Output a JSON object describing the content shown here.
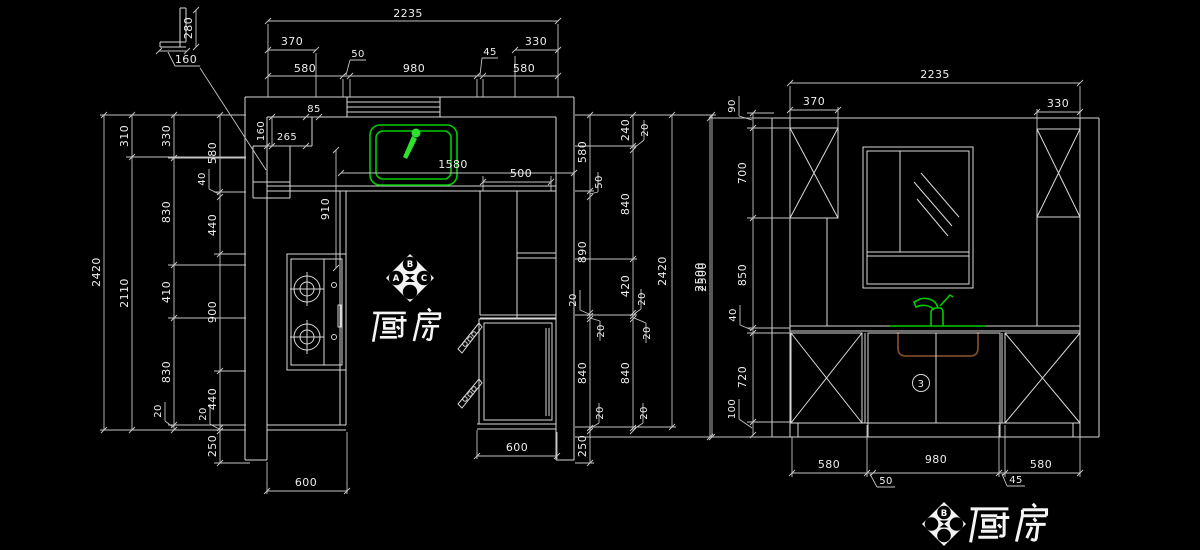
{
  "colors": {
    "background": "#000000",
    "line": "#d9d9d9",
    "dim_text": "#ededed",
    "sink_green": "#00cc00",
    "bowl_brown": "#7a4a28"
  },
  "plan": {
    "room_label": "厨房",
    "marker": {
      "top": "B",
      "left": "A",
      "right": "C"
    },
    "detail_dims": {
      "height": "280",
      "width": "160"
    },
    "top_dims": {
      "total": "2235",
      "row2_left": "370",
      "row2_right": "330",
      "row3": [
        "580",
        "50",
        "980",
        "45",
        "580"
      ]
    },
    "left_dims": {
      "col1": "2420",
      "col2": [
        "310",
        "2110"
      ],
      "col3": [
        "330",
        "830",
        "410",
        "830",
        "20"
      ],
      "col4": [
        "580",
        "40",
        "440",
        "900",
        "440",
        "20",
        "250"
      ]
    },
    "right_dims": {
      "col1": [
        "580",
        "50",
        "890",
        "20",
        "20",
        "840",
        "20",
        "250"
      ],
      "col2": [
        "240",
        "20",
        "840",
        "420",
        "20",
        "20",
        "840",
        "20"
      ],
      "col3": "2420",
      "col4": "2500"
    },
    "inner_dims": {
      "pier": "85",
      "niche_depth": "160",
      "niche_width": "265",
      "counter_run": "910",
      "top_span": "1580",
      "cabinet_depth": "500",
      "fridge_width": "600",
      "counter_width": "600"
    }
  },
  "elevation": {
    "room_label": "厨房",
    "marker": {
      "top": "B"
    },
    "cabinet_callout": "3",
    "top_dims": {
      "total": "2235",
      "left_cabinet": "370",
      "right_cabinet": "330"
    },
    "left_dims": {
      "total": "2500",
      "chain": [
        "90",
        "700",
        "850",
        "40",
        "720",
        "100"
      ]
    },
    "bottom_dims": [
      "580",
      "50",
      "980",
      "45",
      "580"
    ]
  }
}
